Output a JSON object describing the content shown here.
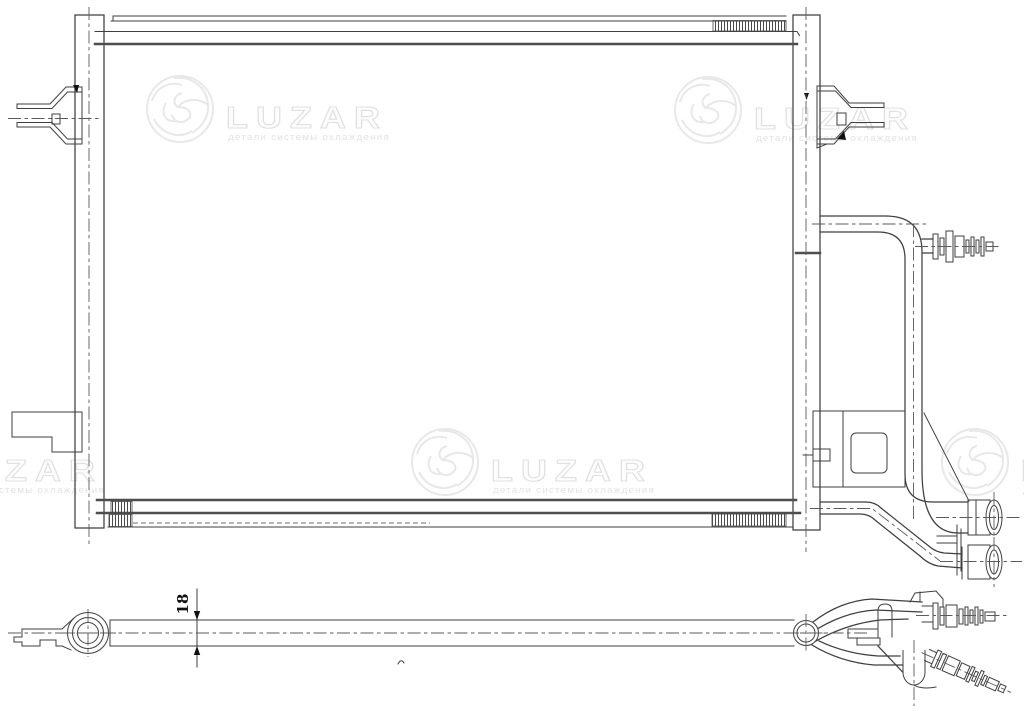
{
  "canvas": {
    "width": 1024,
    "height": 711,
    "background": "#ffffff"
  },
  "watermark": {
    "brand": "LUZAR",
    "subtitle": "детали системы охлаждения",
    "color": "#e8e8e8",
    "instances": 5
  },
  "dimension": {
    "value": "18"
  },
  "colors": {
    "line": "#3f3f3f",
    "thick_line": "#4e4e4e",
    "centerline": "#5b5b5b",
    "hidden_line": "#6e6e6e",
    "arrow": "#111111",
    "background": "#ffffff"
  }
}
